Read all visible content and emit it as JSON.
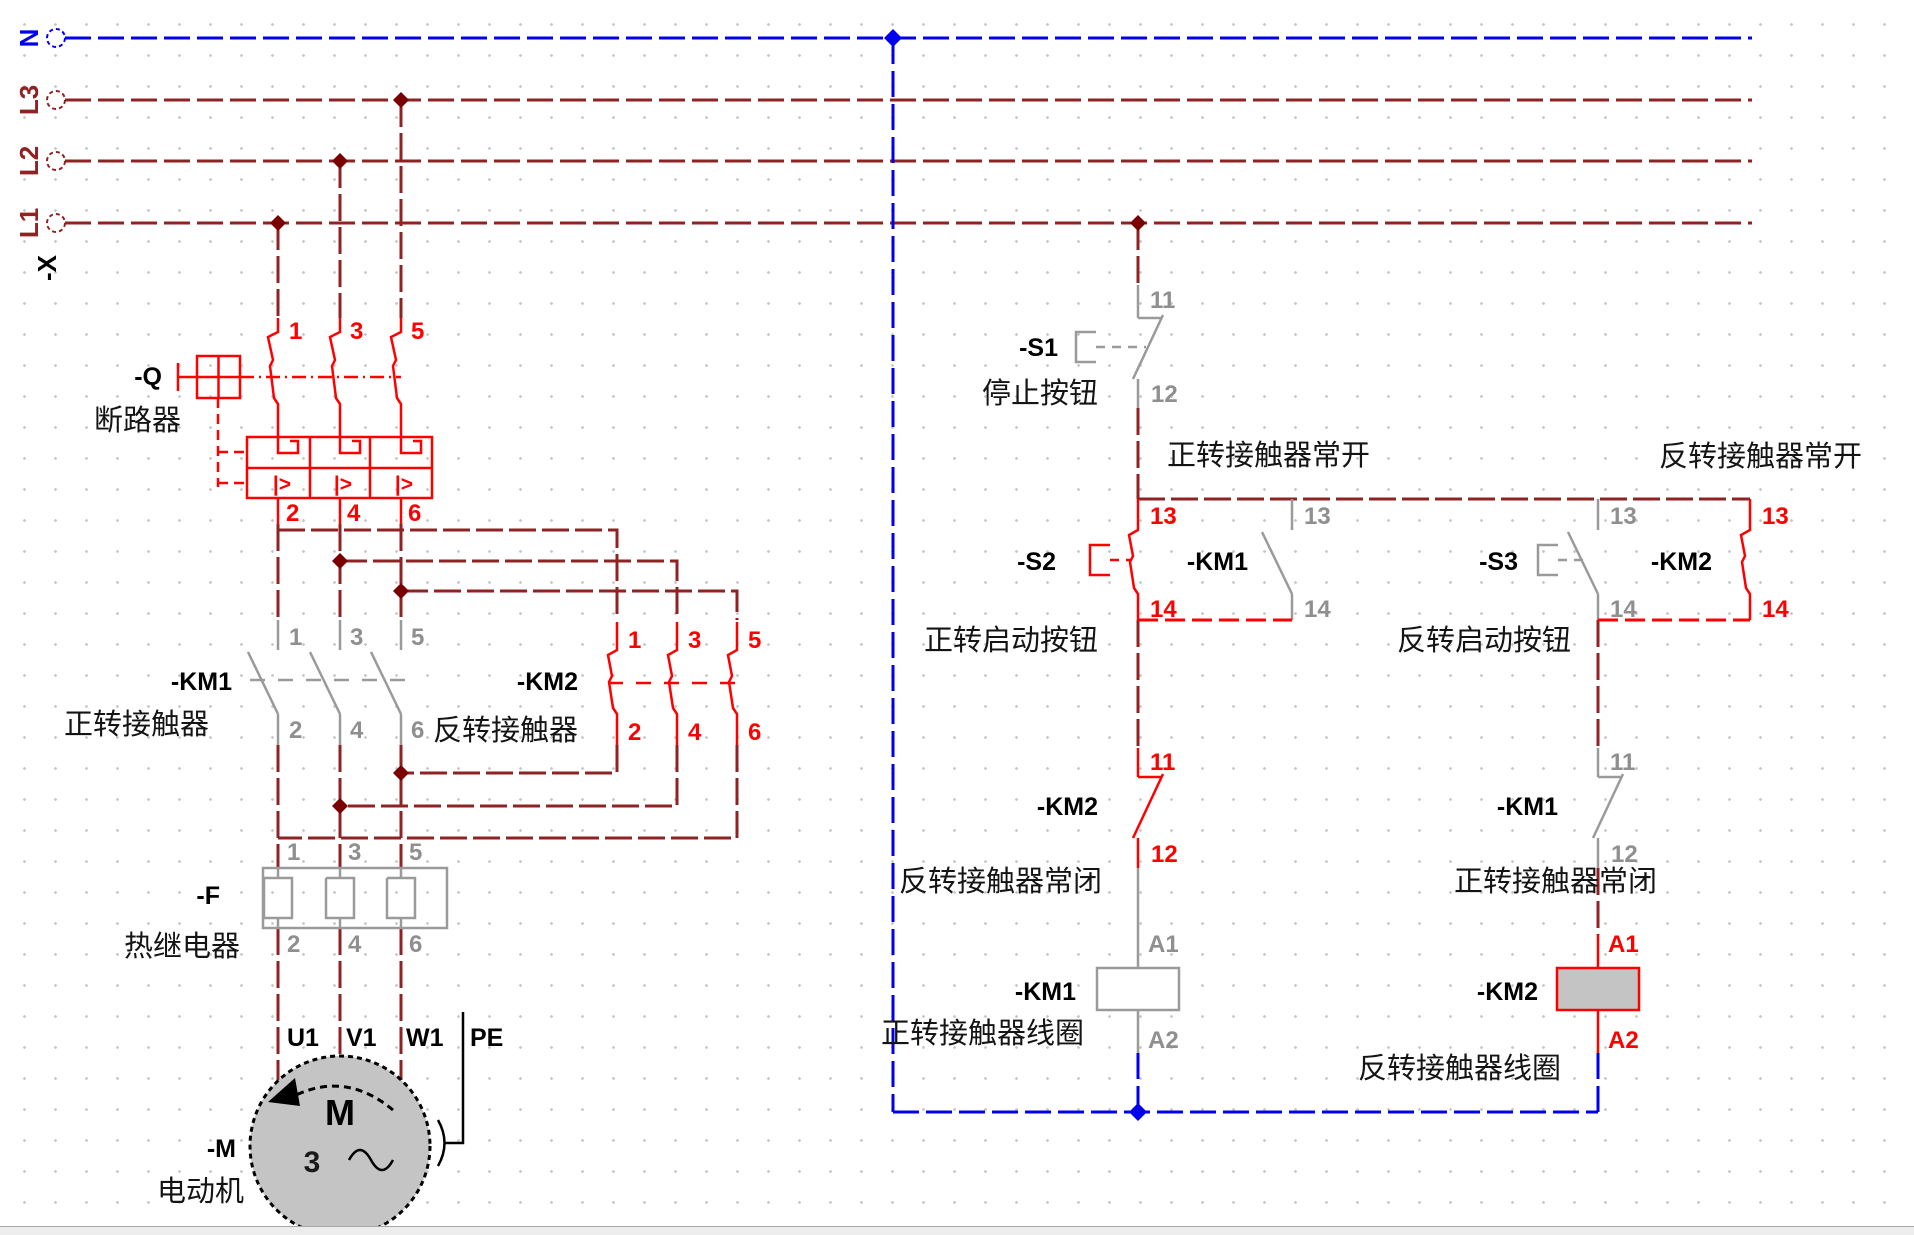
{
  "colors": {
    "wire_dark_red": "#8F2323",
    "active_red": "#FF0000",
    "neutral_blue": "#0000EE",
    "symbol_gray": "#9A9A9A",
    "pin_gray": "#8F8F8F",
    "junction_dark": "#7A0000",
    "coil_fill": "#C4C4C4",
    "motor_fill": "#C4C4C4"
  },
  "power_rails": {
    "n": "N",
    "l3": "L3",
    "l2": "L2",
    "l1": "L1",
    "terminal_strip": "-X"
  },
  "breaker": {
    "tag": "-Q",
    "caption": "断路器",
    "pins_top": [
      "1",
      "3",
      "5"
    ],
    "pins_bottom": [
      "2",
      "4",
      "6"
    ],
    "trip_symbol": "|>"
  },
  "km1_main": {
    "tag": "-KM1",
    "caption": "正转接触器",
    "pins_top": [
      "1",
      "3",
      "5"
    ],
    "pins_bottom": [
      "2",
      "4",
      "6"
    ]
  },
  "km2_main": {
    "tag": "-KM2",
    "caption": "反转接触器",
    "pins_top": [
      "1",
      "3",
      "5"
    ],
    "pins_bottom": [
      "2",
      "4",
      "6"
    ]
  },
  "thermal_relay": {
    "tag": "-F",
    "caption": "热继电器",
    "pins_top": [
      "1",
      "3",
      "5"
    ],
    "pins_bottom": [
      "2",
      "4",
      "6"
    ]
  },
  "motor": {
    "tag": "-M",
    "caption": "电动机",
    "symbol_letter": "M",
    "phase_count": "3",
    "terminals": [
      "U1",
      "V1",
      "W1",
      "PE"
    ]
  },
  "stop_button": {
    "tag": "-S1",
    "caption": "停止按钮",
    "pins": [
      "11",
      "12"
    ]
  },
  "fwd_start_button": {
    "tag": "-S2",
    "caption": "正转启动按钮",
    "pins": [
      "13",
      "14"
    ]
  },
  "km1_no_contact": {
    "tag": "-KM1",
    "caption": "正转接触器常开",
    "pins": [
      "13",
      "14"
    ]
  },
  "rev_start_button": {
    "tag": "-S3",
    "caption": "反转启动按钮",
    "pins": [
      "13",
      "14"
    ]
  },
  "km2_no_contact": {
    "tag": "-KM2",
    "caption": "反转接触器常开",
    "pins": [
      "13",
      "14"
    ]
  },
  "km2_nc_contact": {
    "tag": "-KM2",
    "caption": "反转接触器常闭",
    "pins": [
      "11",
      "12"
    ]
  },
  "km1_nc_contact": {
    "tag": "-KM1",
    "caption": "正转接触器常闭",
    "pins": [
      "11",
      "12"
    ]
  },
  "km1_coil": {
    "tag": "-KM1",
    "caption": "正转接触器线圈",
    "pins": [
      "A1",
      "A2"
    ]
  },
  "km2_coil": {
    "tag": "-KM2",
    "caption": "反转接触器线圈",
    "pins": [
      "A1",
      "A2"
    ]
  }
}
